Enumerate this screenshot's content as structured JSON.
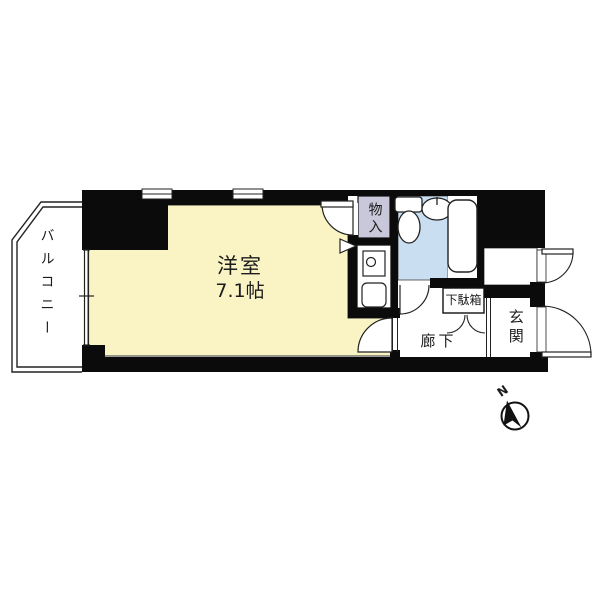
{
  "floorplan": {
    "balcony": {
      "label": "バルコニー"
    },
    "western_room": {
      "label": "洋室",
      "size": "7.1帖"
    },
    "closet": {
      "label": "物入"
    },
    "shoe_cabinet": {
      "label": "下駄箱"
    },
    "corridor": {
      "label": "廊下"
    },
    "entrance": {
      "label": "玄関"
    },
    "compass": {
      "north_label": "N"
    },
    "colors": {
      "room_fill": "#FAF3C4",
      "bathroom_fill": "#C9DEF1",
      "closet_fill": "#C9C8DB",
      "wall": "#0B0B0B",
      "line": "#222222",
      "background": "#FFFFFF"
    },
    "icons": [
      "toilet-icon",
      "wash-basin-icon",
      "bathtub-icon",
      "stove-icon",
      "sink-icon",
      "compass-icon",
      "window-icon",
      "door-swing-icon"
    ]
  }
}
